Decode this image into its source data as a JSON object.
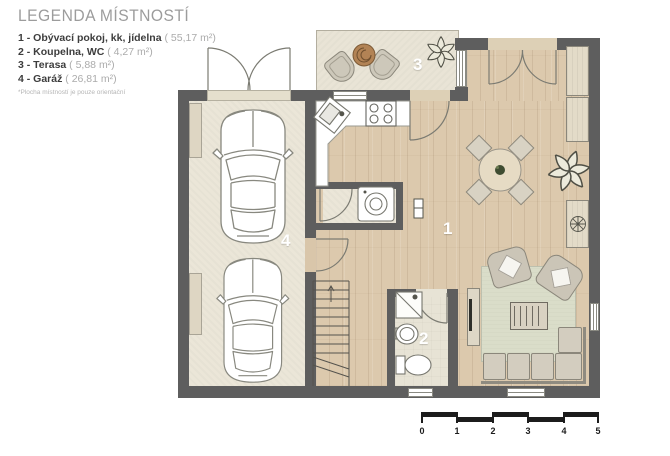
{
  "legend": {
    "title": "LEGENDA MÍSTNOSTÍ",
    "items": [
      {
        "label": "1 - Obývací pokoj, kk, jídelna",
        "area": "( 55,17 m²)"
      },
      {
        "label": "2 - Koupelna, WC",
        "area": "( 4,27 m²)"
      },
      {
        "label": "3 - Terasa",
        "area": "( 5,88 m²)"
      },
      {
        "label": "4 - Garáž",
        "area": "( 26,81 m²)"
      }
    ],
    "footnote": "*Plocha místností je pouze orientační"
  },
  "plan": {
    "rooms": {
      "living": "1",
      "bathroom": "2",
      "terrace": "3",
      "garage": "4"
    }
  },
  "scale_bar": {
    "labels": [
      "0",
      "1",
      "2",
      "3",
      "4",
      "5"
    ]
  },
  "colors": {
    "wall": "#5e5e5e",
    "wood": "#dcc9ad",
    "garage_floor": "#ebe6d8",
    "terrace_floor": "#e9e4d6",
    "bath_floor": "#e7e3d5",
    "rug": "#daddc9",
    "furniture": "#d3cdbf",
    "label": "#ffffff",
    "legend_title": "#9c9c9c",
    "legend_text": "#3d3d3d",
    "legend_area": "#ababab",
    "scale": "#1c1c1c"
  }
}
